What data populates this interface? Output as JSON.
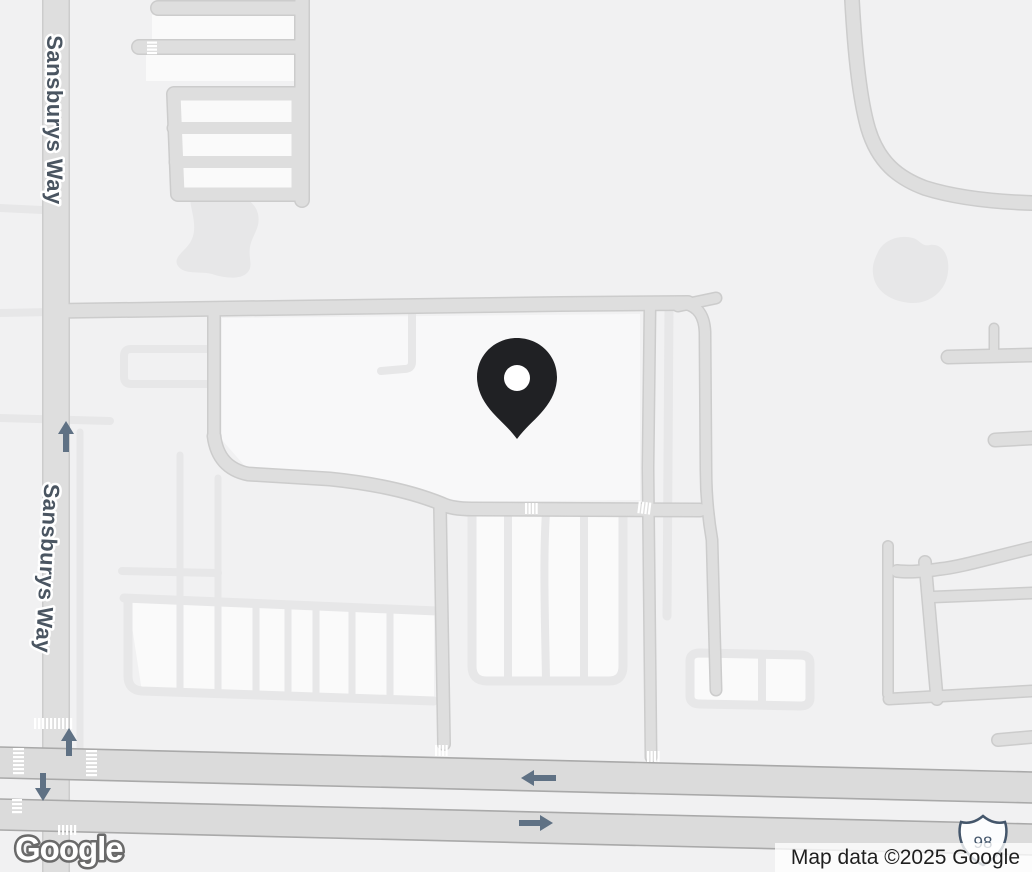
{
  "canvas": {
    "width": 1032,
    "height": 872
  },
  "road_labels": [
    {
      "text": "Sansburys Way"
    },
    {
      "text": "Sansburys Way"
    }
  ],
  "marker": {
    "kind": "place-pin",
    "color": "#202124"
  },
  "route_shield": {
    "system": "US Route",
    "number": "98"
  },
  "footer": {
    "logo_text": "Google",
    "attribution": "Map data ©2025 Google"
  },
  "icons": {
    "marker": "location-pin",
    "arrows": [
      "one-way-up-arrow",
      "one-way-up-arrow",
      "one-way-down-arrow",
      "one-way-left-arrow",
      "one-way-right-arrow"
    ],
    "shield": "us-route-shield"
  },
  "colors": {
    "background": "#f1f1f2",
    "parcel": "#f8f8f9",
    "parking_interior": "#fafafa",
    "pond": "#e7e7e8",
    "road_light": "#e7e7e8",
    "road_medium": "#dedede",
    "road_casing": "#cccccc",
    "highway": "#dbdbdb",
    "highway_edge": "#a9a9a9",
    "crosswalk": "#ffffff",
    "label_text": "#4a5561",
    "arrow": "#5f7184",
    "marker_fill": "#202124",
    "shield_outline": "#44566b",
    "attribution_text": "#1f1f1f",
    "logo_outline": "#6a6a6a"
  }
}
